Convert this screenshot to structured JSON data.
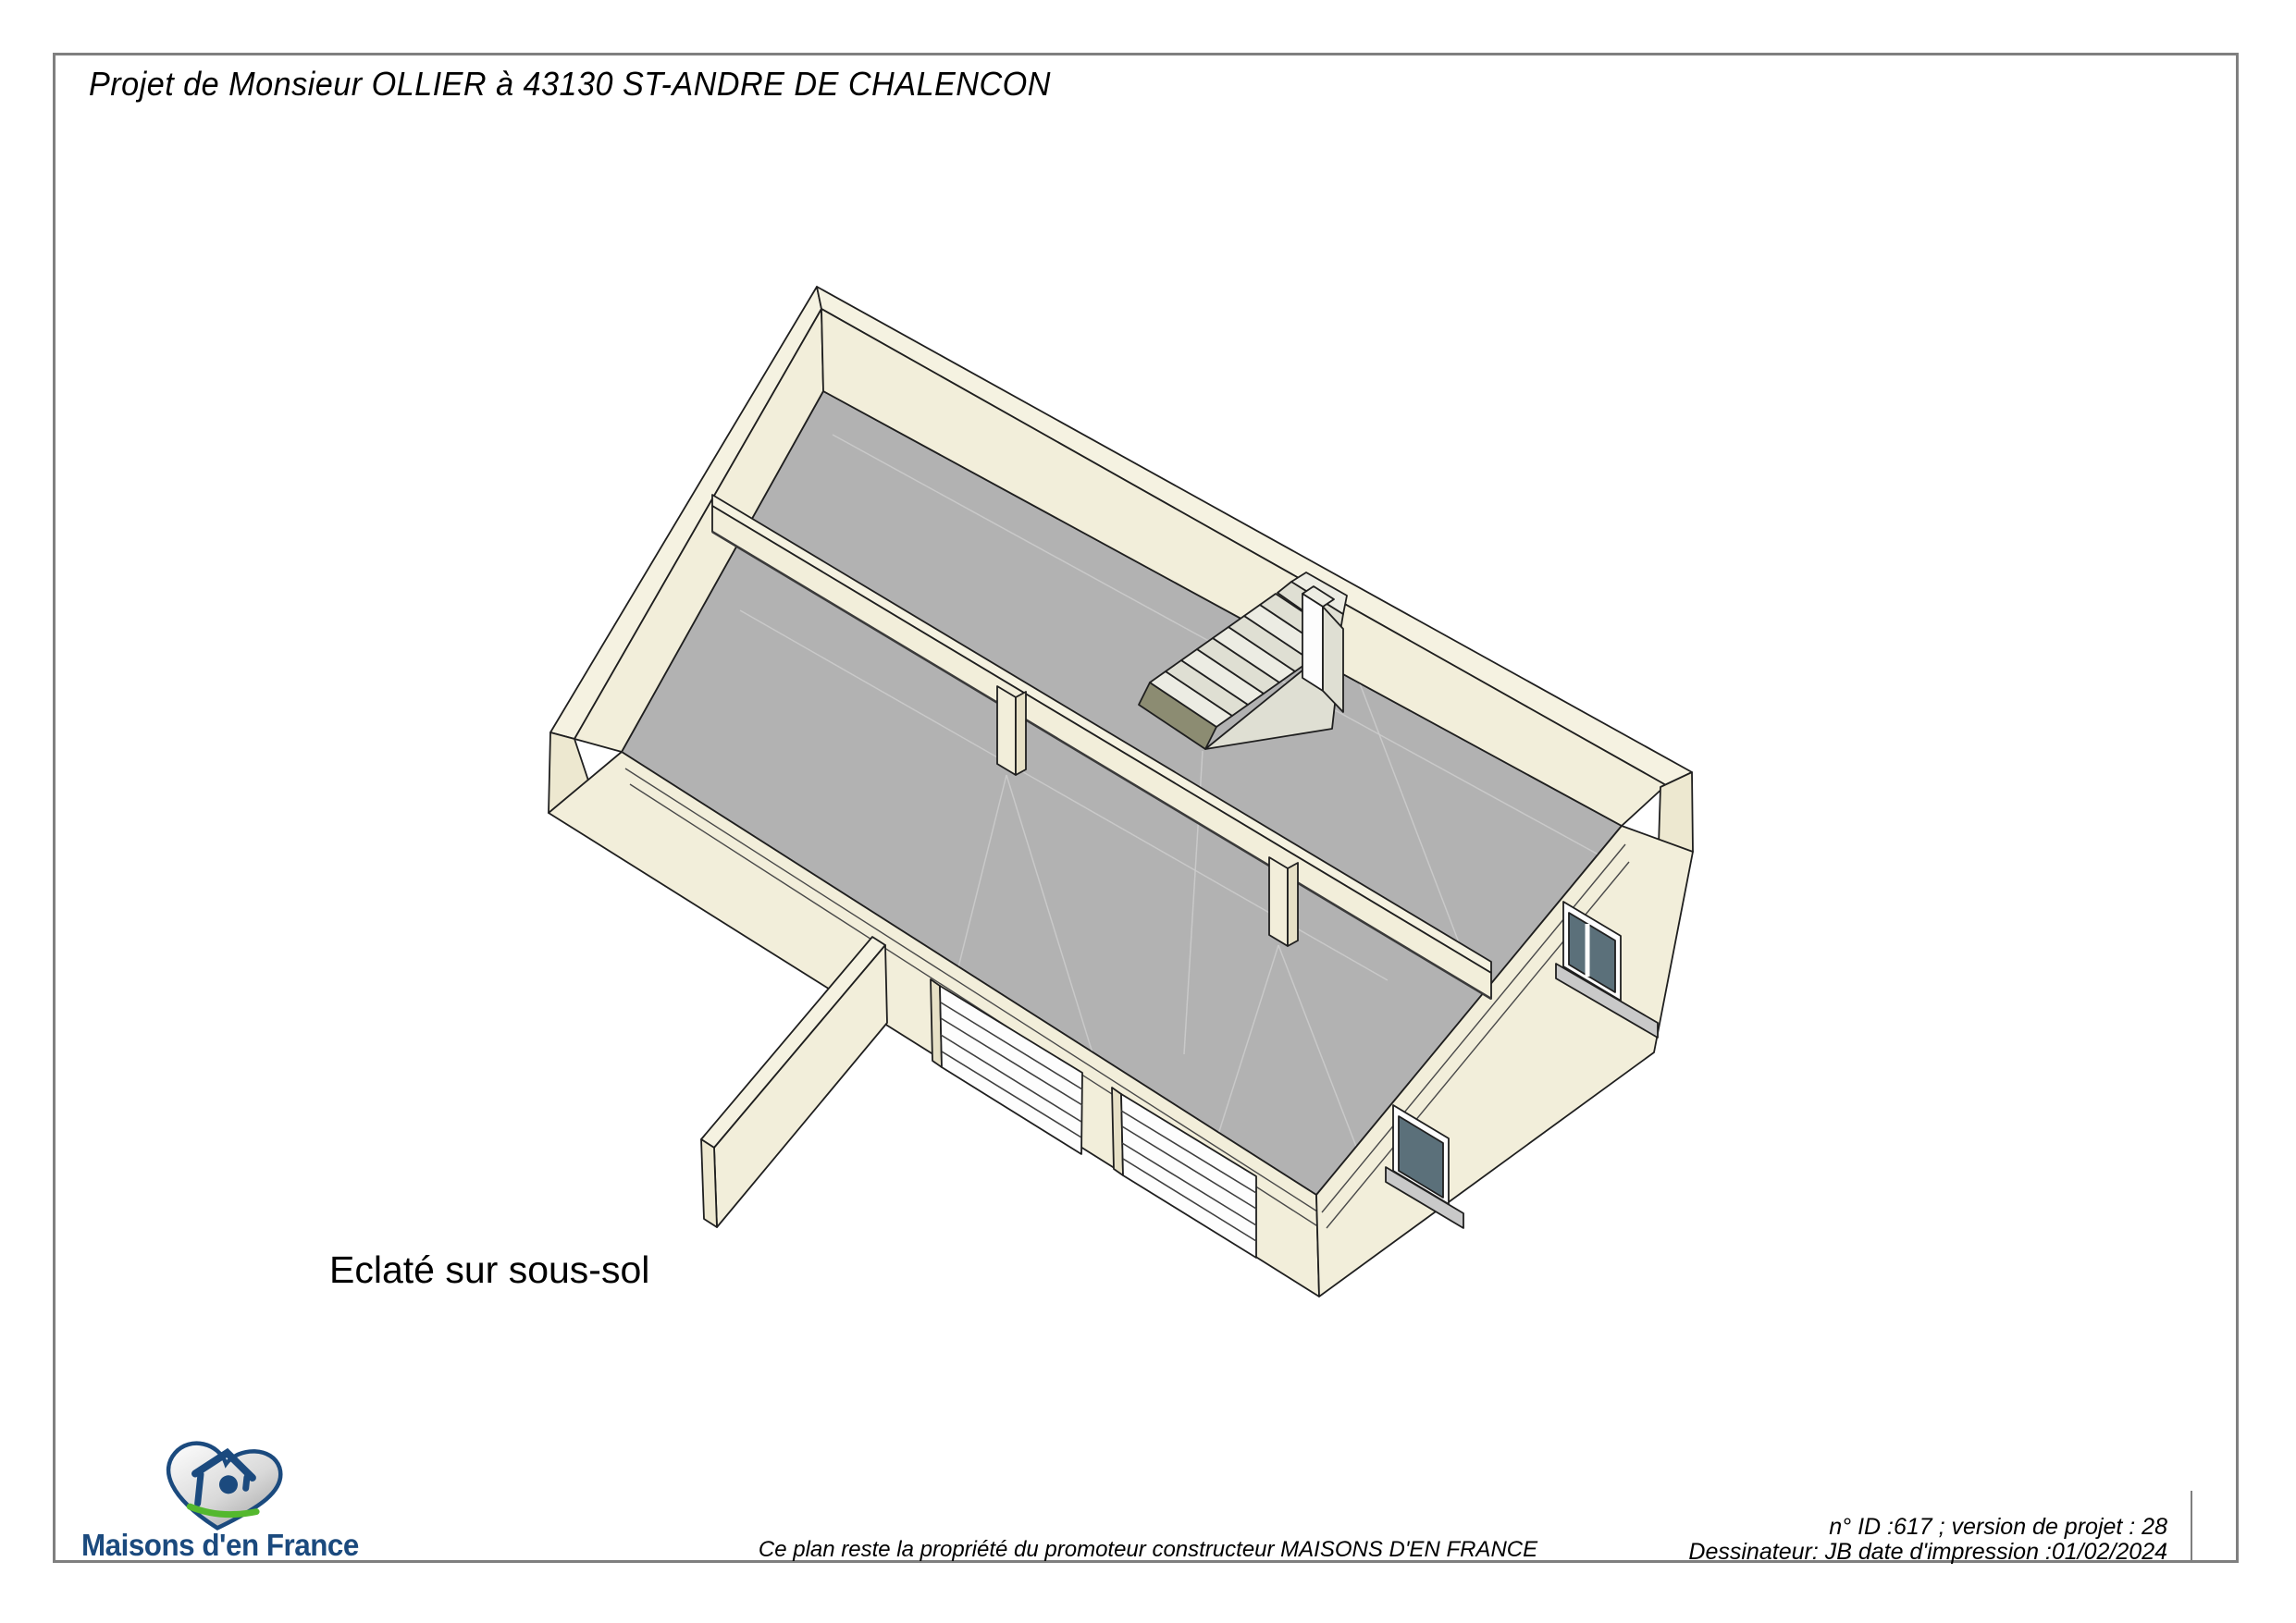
{
  "page": {
    "title": "Projet de Monsieur OLLIER à 43130 ST-ANDRE DE CHALENCON",
    "drawing_label": "Eclaté sur sous-sol"
  },
  "footer": {
    "copyright_line": "Ce plan reste la propriété du promoteur constructeur MAISONS D'EN FRANCE",
    "info_line1": "n° ID :617 ; version de projet : 28",
    "info_line2": "Dessinateur: JB  date d'impression :01/02/2024",
    "brand_name": "Maisons d'en France",
    "logo_icon": "heart-with-house-icon"
  },
  "colors": {
    "frame": "#7f7f7f",
    "outline": "#1f1f1f",
    "wall_top": "#f5f2e1",
    "wall_light": "#f2eeda",
    "wall_mid": "#ede8d0",
    "wall_dark": "#e6e0c6",
    "floor": "#b2b2b2",
    "door_white": "#fdfdfd",
    "glass": "#5b707a",
    "sill": "#c9c9c9",
    "step_top": "#ecece3",
    "step_face": "#dfdfd3",
    "step_dark": "#8c8c72",
    "faint_line": "#cdcdcd",
    "brand_navy": "#1b4a7e",
    "brand_green": "#54b82e",
    "heart_silver": "#b9b9b9"
  }
}
